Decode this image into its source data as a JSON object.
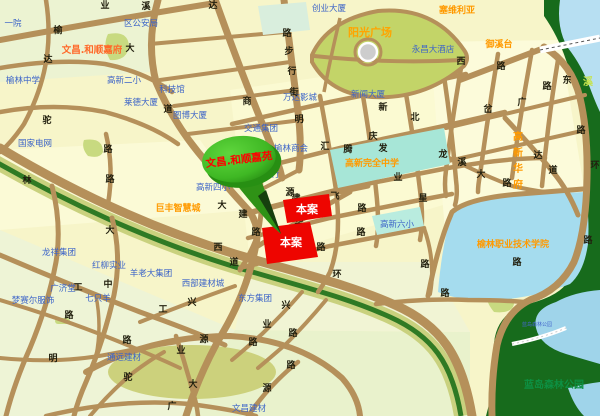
{
  "map": {
    "site_label_1": "本案",
    "site_label_2": "本案",
    "balloon_text": "文昌.和顺嘉苑",
    "colors": {
      "background": "#f7f5c9",
      "block_green": "#e9f2cf",
      "road": "#b5905a",
      "site_red": "#ee0500",
      "balloon_green": "#46c02b",
      "forest": "#176b1c",
      "lake_cyan": "#a5dcee",
      "school_cyan": "#a7e6d7",
      "river_blue": "#b7dff2",
      "park_green": "#c3d468",
      "greenbelt": "#2f7a24",
      "olive": "#ccd17c",
      "label_blue": "#3c64c8",
      "label_orange": "#ff9a00",
      "balloon_text_red": "#ff0000"
    },
    "labels": [
      {
        "t": "一院",
        "x": 13,
        "y": 26,
        "type": "lb"
      },
      {
        "t": "区公安局",
        "x": 141,
        "y": 26,
        "type": "lb"
      },
      {
        "t": "文昌.和顺嘉府",
        "x": 92,
        "y": 53,
        "type": "lor"
      },
      {
        "t": "榆林中学",
        "x": 23,
        "y": 83,
        "type": "lb"
      },
      {
        "t": "高新二小",
        "x": 124,
        "y": 83,
        "type": "lb"
      },
      {
        "t": "科技馆",
        "x": 172,
        "y": 92,
        "type": "lb"
      },
      {
        "t": "莱德大厦",
        "x": 141,
        "y": 105,
        "type": "lb"
      },
      {
        "t": "图博大厦",
        "x": 190,
        "y": 118,
        "type": "lb"
      },
      {
        "t": "国家电网",
        "x": 35,
        "y": 146,
        "type": "lb"
      },
      {
        "t": "万达影城",
        "x": 300,
        "y": 100,
        "type": "lb"
      },
      {
        "t": "交通集团",
        "x": 261,
        "y": 131,
        "type": "lb"
      },
      {
        "t": "榆林商会",
        "x": 291,
        "y": 151,
        "type": "lb"
      },
      {
        "t": "银行",
        "x": 271,
        "y": 177,
        "type": "lb"
      },
      {
        "t": "新闻大厦",
        "x": 368,
        "y": 97,
        "type": "lb"
      },
      {
        "t": "创业大厦",
        "x": 329,
        "y": 11,
        "type": "lb"
      },
      {
        "t": "永昌大酒店",
        "x": 433,
        "y": 52,
        "type": "lb"
      },
      {
        "t": "高新四小",
        "x": 213,
        "y": 190,
        "type": "lb"
      },
      {
        "t": "巨丰智慧城",
        "x": 178,
        "y": 211,
        "type": "lo"
      },
      {
        "t": "龙祥集团",
        "x": 59,
        "y": 255,
        "type": "lb"
      },
      {
        "t": "红柳实业",
        "x": 109,
        "y": 268,
        "type": "lb"
      },
      {
        "t": "羊老大集团",
        "x": 151,
        "y": 276,
        "type": "lb"
      },
      {
        "t": "西部建材城",
        "x": 203,
        "y": 286,
        "type": "lb"
      },
      {
        "t": "东方集团",
        "x": 255,
        "y": 301,
        "type": "lb"
      },
      {
        "t": "广济堂",
        "x": 63,
        "y": 291,
        "type": "lb"
      },
      {
        "t": "梦赛尔服饰",
        "x": 33,
        "y": 303,
        "type": "lb"
      },
      {
        "t": "七只羊",
        "x": 98,
        "y": 301,
        "type": "lb"
      },
      {
        "t": "通远建材",
        "x": 124,
        "y": 360,
        "type": "lb"
      },
      {
        "t": "文昌建材",
        "x": 249,
        "y": 411,
        "type": "lb"
      },
      {
        "t": "高新六小",
        "x": 397,
        "y": 227,
        "type": "lb"
      },
      {
        "t": "塞维利亚",
        "x": 457,
        "y": 13,
        "type": "lo"
      },
      {
        "t": "御溪台",
        "x": 499,
        "y": 47,
        "type": "lo"
      },
      {
        "t": "阳光广场",
        "x": 370,
        "y": 36,
        "type": "lob"
      },
      {
        "t": "高新完全中学",
        "x": 372,
        "y": 166,
        "type": "lo"
      },
      {
        "t": "榆林职业技术学院",
        "x": 513,
        "y": 247,
        "type": "lo"
      },
      {
        "t": "高新华府",
        "x": 518,
        "y": 140,
        "type": "ov",
        "v": true
      },
      {
        "t": "蓝岛森林公园",
        "x": 554,
        "y": 388,
        "type": "lg"
      },
      {
        "t": "蓝岛森林公园",
        "x": 537,
        "y": 326,
        "type": "ltb"
      }
    ],
    "road_chars": [
      {
        "c": "业",
        "x": 105,
        "y": 8
      },
      {
        "c": "溪",
        "x": 146,
        "y": 9
      },
      {
        "c": "达",
        "x": 213,
        "y": 8
      },
      {
        "c": "榆",
        "x": 58,
        "y": 33
      },
      {
        "c": "大",
        "x": 130,
        "y": 51
      },
      {
        "c": "达",
        "x": 48,
        "y": 62
      },
      {
        "c": "路",
        "x": 287,
        "y": 36
      },
      {
        "c": "步",
        "x": 289,
        "y": 54
      },
      {
        "c": "行",
        "x": 292,
        "y": 74
      },
      {
        "c": "街",
        "x": 294,
        "y": 95
      },
      {
        "c": "商",
        "x": 247,
        "y": 104
      },
      {
        "c": "道",
        "x": 168,
        "y": 112
      },
      {
        "c": "明",
        "x": 299,
        "y": 122
      },
      {
        "c": "驼",
        "x": 47,
        "y": 123
      },
      {
        "c": "路",
        "x": 108,
        "y": 152
      },
      {
        "c": "路",
        "x": 110,
        "y": 182
      },
      {
        "c": "林",
        "x": 27,
        "y": 183
      },
      {
        "c": "大",
        "x": 222,
        "y": 208
      },
      {
        "c": "大",
        "x": 110,
        "y": 233
      },
      {
        "c": "西",
        "x": 218,
        "y": 250
      },
      {
        "c": "道",
        "x": 234,
        "y": 265
      },
      {
        "c": "环",
        "x": 337,
        "y": 277
      },
      {
        "c": "裕",
        "x": 259,
        "y": 192
      },
      {
        "c": "路",
        "x": 256,
        "y": 235
      },
      {
        "c": "源",
        "x": 290,
        "y": 195
      },
      {
        "c": "建",
        "x": 296,
        "y": 201
      },
      {
        "c": "建",
        "x": 243,
        "y": 217
      },
      {
        "c": "业",
        "x": 398,
        "y": 180
      },
      {
        "c": "汇",
        "x": 325,
        "y": 149
      },
      {
        "c": "飞",
        "x": 335,
        "y": 199
      },
      {
        "c": "华",
        "x": 313,
        "y": 211
      },
      {
        "c": "华",
        "x": 299,
        "y": 225
      },
      {
        "c": "路",
        "x": 321,
        "y": 250
      },
      {
        "c": "路",
        "x": 362,
        "y": 211
      },
      {
        "c": "路",
        "x": 361,
        "y": 235
      },
      {
        "c": "北",
        "x": 415,
        "y": 120
      },
      {
        "c": "庆",
        "x": 373,
        "y": 139
      },
      {
        "c": "新",
        "x": 383,
        "y": 110
      },
      {
        "c": "星",
        "x": 423,
        "y": 201
      },
      {
        "c": "腾",
        "x": 348,
        "y": 152
      },
      {
        "c": "发",
        "x": 383,
        "y": 151
      },
      {
        "c": "龙",
        "x": 443,
        "y": 157
      },
      {
        "c": "溪",
        "x": 462,
        "y": 165
      },
      {
        "c": "大",
        "x": 481,
        "y": 177
      },
      {
        "c": "路",
        "x": 507,
        "y": 186
      },
      {
        "c": "达",
        "x": 538,
        "y": 158
      },
      {
        "c": "道",
        "x": 553,
        "y": 173
      },
      {
        "c": "环",
        "x": 595,
        "y": 168
      },
      {
        "c": "东",
        "x": 567,
        "y": 83
      },
      {
        "c": "路",
        "x": 547,
        "y": 89
      },
      {
        "c": "路",
        "x": 501,
        "y": 69
      },
      {
        "c": "西",
        "x": 461,
        "y": 64
      },
      {
        "c": "广",
        "x": 522,
        "y": 105
      },
      {
        "c": "岔",
        "x": 488,
        "y": 112
      },
      {
        "c": "路",
        "x": 581,
        "y": 133
      },
      {
        "c": "路",
        "x": 588,
        "y": 243
      },
      {
        "c": "路",
        "x": 425,
        "y": 267
      },
      {
        "c": "路",
        "x": 445,
        "y": 296
      },
      {
        "c": "路",
        "x": 517,
        "y": 265
      },
      {
        "c": "工",
        "x": 78,
        "y": 290
      },
      {
        "c": "中",
        "x": 108,
        "y": 287
      },
      {
        "c": "路",
        "x": 69,
        "y": 318
      },
      {
        "c": "路",
        "x": 127,
        "y": 343
      },
      {
        "c": "明",
        "x": 53,
        "y": 361
      },
      {
        "c": "驼",
        "x": 128,
        "y": 380
      },
      {
        "c": "工",
        "x": 163,
        "y": 312
      },
      {
        "c": "兴",
        "x": 192,
        "y": 305
      },
      {
        "c": "兴",
        "x": 286,
        "y": 308
      },
      {
        "c": "业",
        "x": 267,
        "y": 327
      },
      {
        "c": "路",
        "x": 293,
        "y": 336
      },
      {
        "c": "路",
        "x": 253,
        "y": 345
      },
      {
        "c": "路",
        "x": 291,
        "y": 368
      },
      {
        "c": "源",
        "x": 204,
        "y": 342
      },
      {
        "c": "业",
        "x": 181,
        "y": 353
      },
      {
        "c": "大",
        "x": 193,
        "y": 387
      },
      {
        "c": "源",
        "x": 267,
        "y": 391
      },
      {
        "c": "广",
        "x": 172,
        "y": 409
      }
    ],
    "river_chars": [
      {
        "c": "溪",
        "x": 588,
        "y": 85
      }
    ]
  }
}
